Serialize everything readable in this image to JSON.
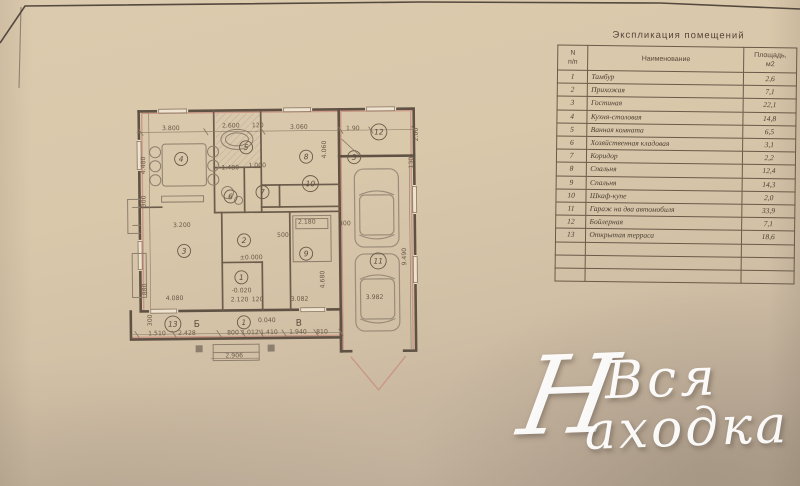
{
  "table": {
    "title": "Экспликация помещений",
    "columns": {
      "num": "N\nп/п",
      "name": "Наименование",
      "area": "Площадь,\nм2"
    },
    "rows": [
      {
        "num": "1",
        "name": "Тамбур",
        "area": "2,6"
      },
      {
        "num": "2",
        "name": "Прихожая",
        "area": "7,1"
      },
      {
        "num": "3",
        "name": "Гостиная",
        "area": "22,1"
      },
      {
        "num": "4",
        "name": "Кухня-столовая",
        "area": "14,8"
      },
      {
        "num": "5",
        "name": "Ванная комната",
        "area": "6,5"
      },
      {
        "num": "6",
        "name": "Хозяйственная кладовая",
        "area": "3,1"
      },
      {
        "num": "7",
        "name": "Коридор",
        "area": "2,2"
      },
      {
        "num": "8",
        "name": "Спальня",
        "area": "12,4"
      },
      {
        "num": "9",
        "name": "Спальня",
        "area": "14,3"
      },
      {
        "num": "10",
        "name": "Шкаф-купе",
        "area": "2,0"
      },
      {
        "num": "11",
        "name": "Гараж на два автомобиля",
        "area": "33,9"
      },
      {
        "num": "12",
        "name": "Бойлерная",
        "area": "7,1"
      },
      {
        "num": "13",
        "name": "Открытая терраса",
        "area": "18,6"
      }
    ],
    "empty_rows": 3
  },
  "plan": {
    "room_numbers": [
      {
        "n": "1",
        "x": 241,
        "y": 277
      },
      {
        "n": "2",
        "x": 244,
        "y": 240
      },
      {
        "n": "3",
        "x": 184,
        "y": 250
      },
      {
        "n": "4",
        "x": 182,
        "y": 158
      },
      {
        "n": "5",
        "x": 247,
        "y": 147
      },
      {
        "n": "6",
        "x": 231,
        "y": 196
      },
      {
        "n": "7",
        "x": 263,
        "y": 192
      },
      {
        "n": "8",
        "x": 307,
        "y": 157
      },
      {
        "n": "9",
        "x": 306,
        "y": 254
      },
      {
        "n": "10",
        "x": 311,
        "y": 184
      },
      {
        "n": "11",
        "x": 378,
        "y": 262
      },
      {
        "n": "12",
        "x": 380,
        "y": 133
      },
      {
        "n": "13",
        "x": 172,
        "y": 323
      },
      {
        "n": "1",
        "x": 243,
        "y": 322
      },
      {
        "n": "3",
        "x": 355,
        "y": 158
      }
    ],
    "axis_labels": [
      {
        "t": "Б",
        "x": 196,
        "y": 326
      },
      {
        "t": "В",
        "x": 298,
        "y": 326
      }
    ],
    "dimensions": [
      {
        "t": "3.800",
        "x": 172,
        "y": 129
      },
      {
        "t": "2.600",
        "x": 232,
        "y": 127
      },
      {
        "t": "120",
        "x": 259,
        "y": 127
      },
      {
        "t": "3.060",
        "x": 300,
        "y": 129
      },
      {
        "t": "1.90",
        "x": 354,
        "y": 131
      },
      {
        "t": "2.00",
        "x": 419,
        "y": 136,
        "r": 90
      },
      {
        "t": "4.060",
        "x": 327,
        "y": 150,
        "r": 90
      },
      {
        "t": "4.480",
        "x": 146,
        "y": 164,
        "r": 90
      },
      {
        "t": "300",
        "x": 146,
        "y": 200,
        "r": 90
      },
      {
        "t": "880",
        "x": 146,
        "y": 288,
        "r": 90
      },
      {
        "t": "3.200",
        "x": 182,
        "y": 226
      },
      {
        "t": "1.480",
        "x": 231,
        "y": 169
      },
      {
        "t": "1.000",
        "x": 258,
        "y": 167
      },
      {
        "t": "2.180",
        "x": 307,
        "y": 224
      },
      {
        "t": "500",
        "x": 283,
        "y": 237
      },
      {
        "t": "±0.000",
        "x": 251,
        "y": 259
      },
      {
        "t": "-0.020",
        "x": 241,
        "y": 292
      },
      {
        "t": "2.120",
        "x": 239,
        "y": 301
      },
      {
        "t": "120",
        "x": 257,
        "y": 301
      },
      {
        "t": "3.082",
        "x": 299,
        "y": 301
      },
      {
        "t": "4.680",
        "x": 324,
        "y": 280,
        "r": 90
      },
      {
        "t": "3.982",
        "x": 374,
        "y": 300
      },
      {
        "t": "9.490",
        "x": 406,
        "y": 258,
        "r": 90
      },
      {
        "t": "400",
        "x": 345,
        "y": 226
      },
      {
        "t": "130",
        "x": 414,
        "y": 164,
        "r": 90
      },
      {
        "t": "4.080",
        "x": 174,
        "y": 299
      },
      {
        "t": "300",
        "x": 151,
        "y": 319,
        "r": 90
      },
      {
        "t": "1.510",
        "x": 156,
        "y": 334
      },
      {
        "t": "2.428",
        "x": 186,
        "y": 334
      },
      {
        "t": "800",
        "x": 232,
        "y": 334
      },
      {
        "t": "1.012",
        "x": 249,
        "y": 334
      },
      {
        "t": "1.410",
        "x": 268,
        "y": 334
      },
      {
        "t": "1.940",
        "x": 297,
        "y": 334
      },
      {
        "t": "810",
        "x": 321,
        "y": 334
      },
      {
        "t": "2.906",
        "x": 233,
        "y": 357
      },
      {
        "t": "0.040",
        "x": 266,
        "y": 322
      }
    ]
  },
  "watermark": {
    "initial": "Н",
    "line1": "Вся",
    "line2": "аходка"
  },
  "colors": {
    "paper": "#d9c7ab",
    "ink": "#5f5244",
    "wall_accent_red": "#c98f7e",
    "hatch_gray": "#a99d90",
    "watermark_white": "#ffffff"
  }
}
